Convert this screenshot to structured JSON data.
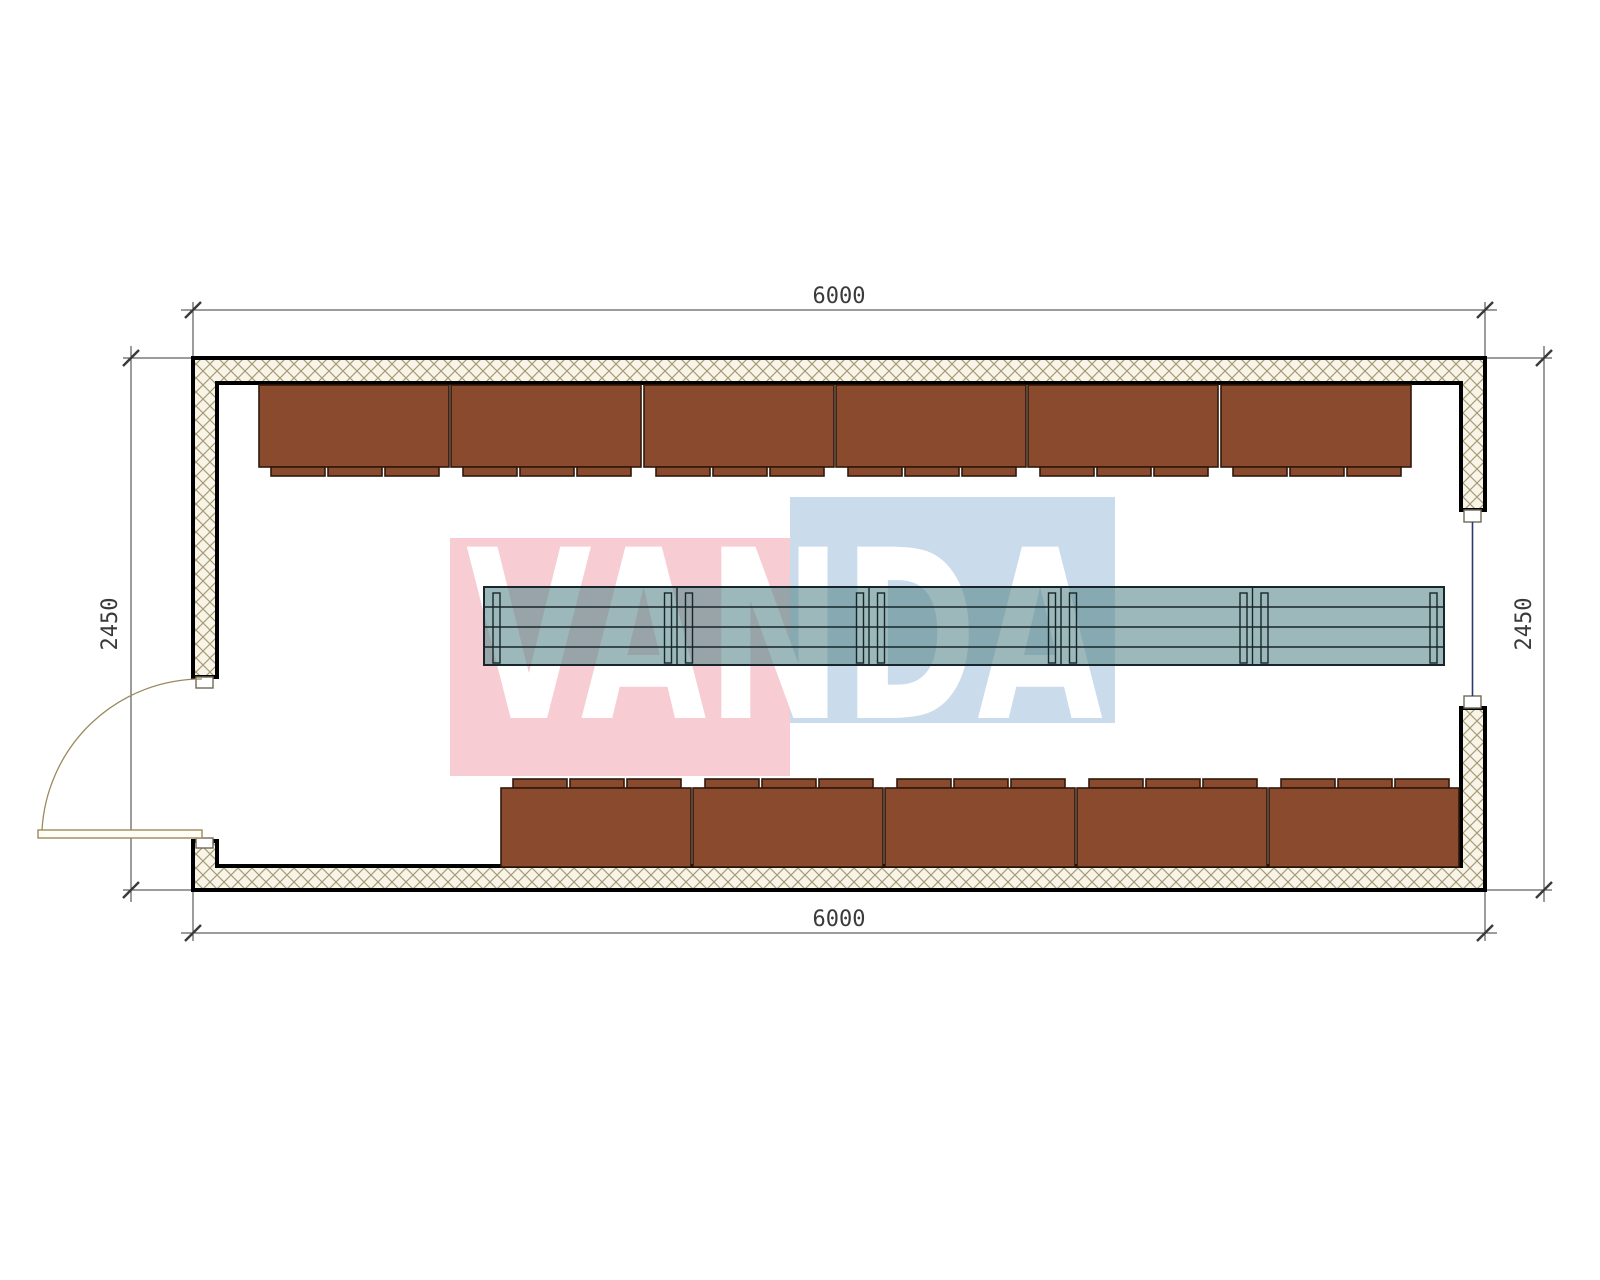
{
  "dimensions": {
    "top": "6000",
    "bottom": "6000",
    "left": "2450",
    "right": "2450"
  },
  "watermark": {
    "text": "VANDA"
  },
  "furniture": {
    "top_bench_count": 6,
    "bottom_bench_count": 5,
    "table_segment_count": 5,
    "feet_per_bench": 3
  },
  "colors": {
    "wall_border": "#000000",
    "hatch_bg": "#f8f4e8",
    "hatch_line": "#a79b76",
    "bench": "#8a4a2d",
    "bench_border": "#30180b",
    "table_fill": "rgba(90,137,140,0.6)",
    "table_border": "#17262a",
    "dimension": "#3a3a3a",
    "door": "#9c8a5e",
    "glazing": "#2a3a70",
    "wm_pink": "#f7ccd3",
    "wm_blue": "#cadbec",
    "wm_text": "#ffffff"
  }
}
